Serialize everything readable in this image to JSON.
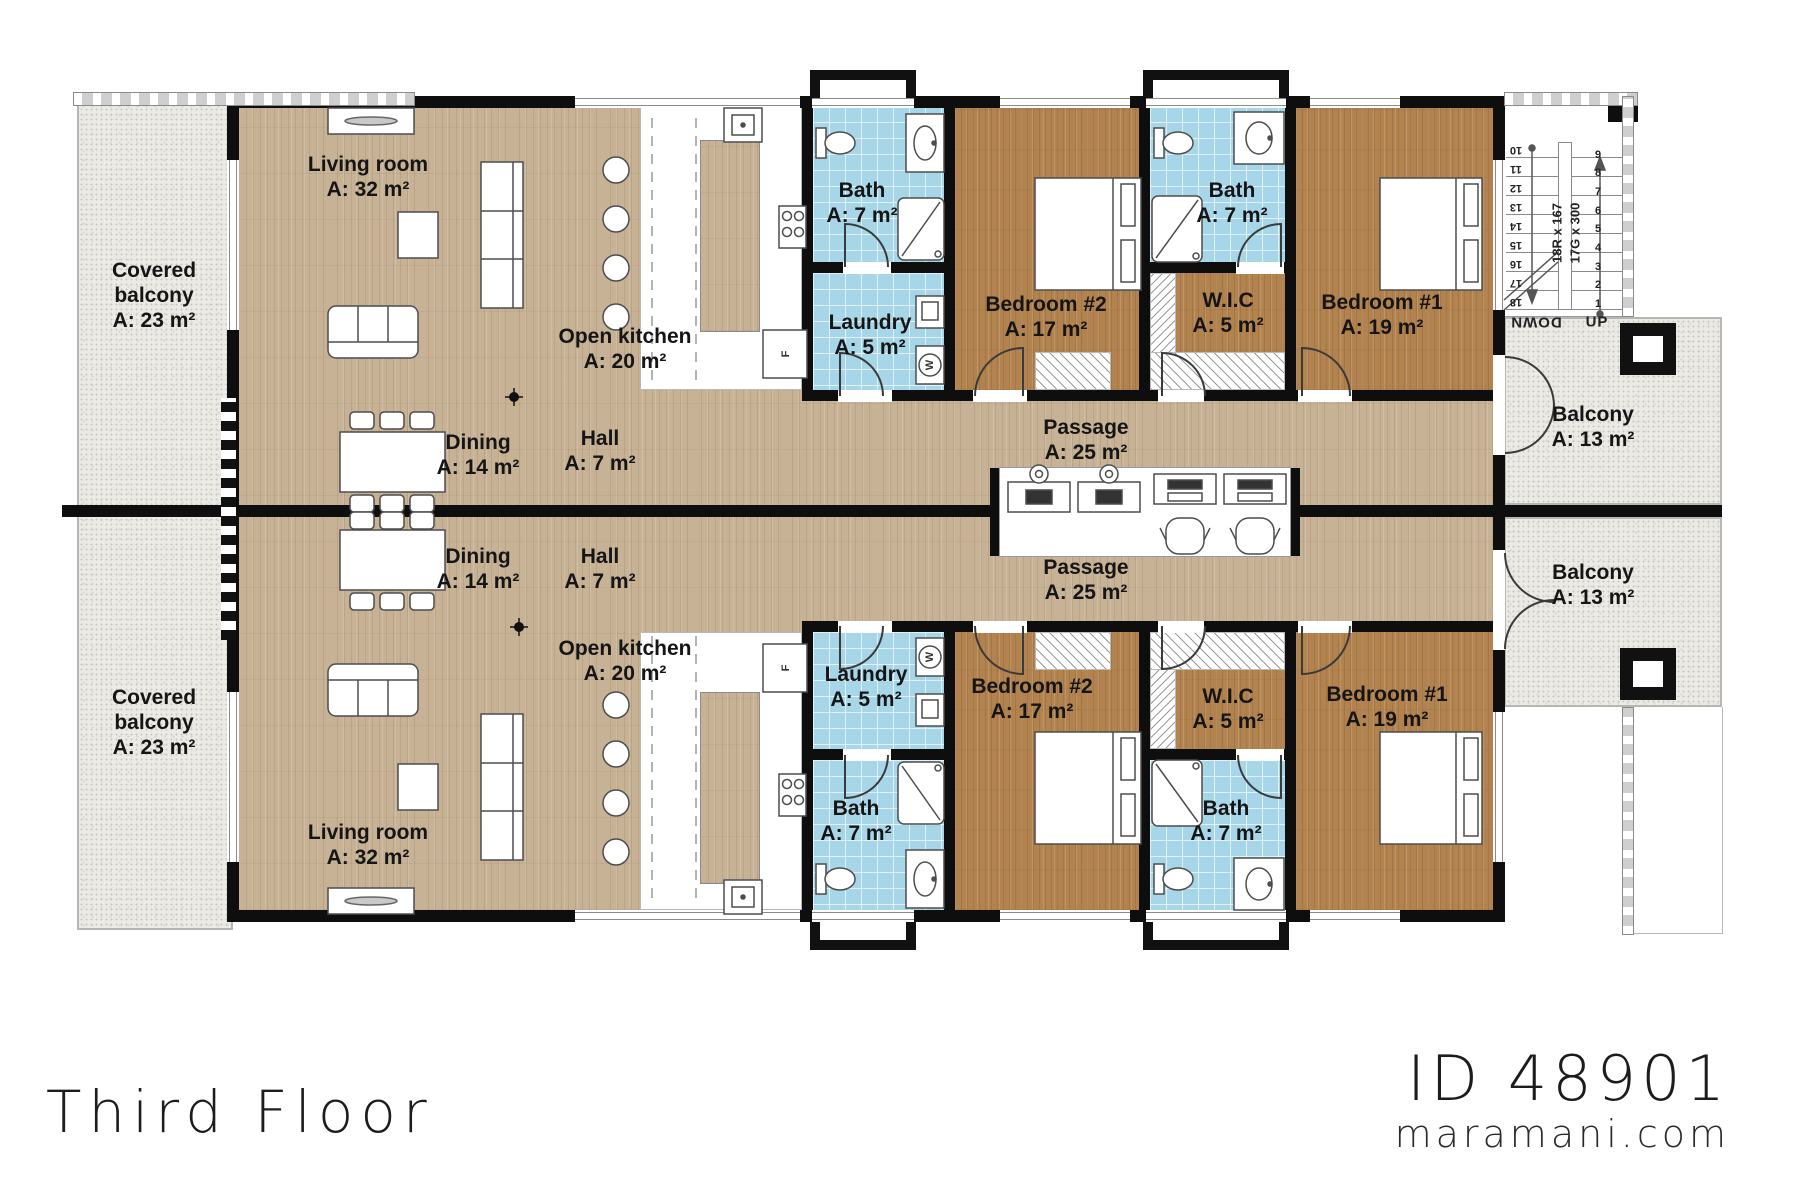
{
  "title": "Third Floor",
  "brand": {
    "plan_id": "ID 48901",
    "website": "maramani.com"
  },
  "appliances": {
    "fridge": "F",
    "washer": "W"
  },
  "stairs": {
    "up": "UP",
    "down": "DOWN",
    "dim1": "18R x 167",
    "dim2": "17G x 300",
    "right_numbers": [
      "9",
      "8",
      "7",
      "6",
      "5",
      "4",
      "3",
      "2",
      "1"
    ],
    "left_numbers": [
      "10",
      "11",
      "12",
      "13",
      "14",
      "15",
      "16",
      "17",
      "18"
    ]
  },
  "units": {
    "top": {
      "covered_balcony": {
        "name": "Covered balcony",
        "area": "A: 23 m²"
      },
      "living_room": {
        "name": "Living room",
        "area": "A: 32 m²"
      },
      "open_kitchen": {
        "name": "Open kitchen",
        "area": "A: 20 m²"
      },
      "dining": {
        "name": "Dining",
        "area": "A: 14 m²"
      },
      "hall": {
        "name": "Hall",
        "area": "A: 7 m²"
      },
      "passage": {
        "name": "Passage",
        "area": "A: 25 m²"
      },
      "bath_1": {
        "name": "Bath",
        "area": "A: 7 m²"
      },
      "laundry": {
        "name": "Laundry",
        "area": "A: 5 m²"
      },
      "bedroom_2": {
        "name": "Bedroom #2",
        "area": "A: 17 m²"
      },
      "bath_2": {
        "name": "Bath",
        "area": "A: 7 m²"
      },
      "wic": {
        "name": "W.I.C",
        "area": "A: 5 m²"
      },
      "bedroom_1": {
        "name": "Bedroom #1",
        "area": "A: 19 m²"
      },
      "balcony": {
        "name": "Balcony",
        "area": "A: 13 m²"
      }
    },
    "bottom": {
      "covered_balcony": {
        "name": "Covered balcony",
        "area": "A: 23 m²"
      },
      "living_room": {
        "name": "Living room",
        "area": "A: 32 m²"
      },
      "open_kitchen": {
        "name": "Open kitchen",
        "area": "A: 20 m²"
      },
      "dining": {
        "name": "Dining",
        "area": "A: 14 m²"
      },
      "hall": {
        "name": "Hall",
        "area": "A: 7 m²"
      },
      "passage": {
        "name": "Passage",
        "area": "A: 25 m²"
      },
      "laundry": {
        "name": "Laundry",
        "area": "A: 5 m²"
      },
      "bath_1": {
        "name": "Bath",
        "area": "A: 7 m²"
      },
      "bedroom_2": {
        "name": "Bedroom #2",
        "area": "A: 17 m²"
      },
      "wic": {
        "name": "W.I.C",
        "area": "A: 5 m²"
      },
      "bath_2": {
        "name": "Bath",
        "area": "A: 7 m²"
      },
      "bedroom_1": {
        "name": "Bedroom #1",
        "area": "A: 19 m²"
      },
      "balcony": {
        "name": "Balcony",
        "area": "A: 13 m²"
      }
    }
  }
}
